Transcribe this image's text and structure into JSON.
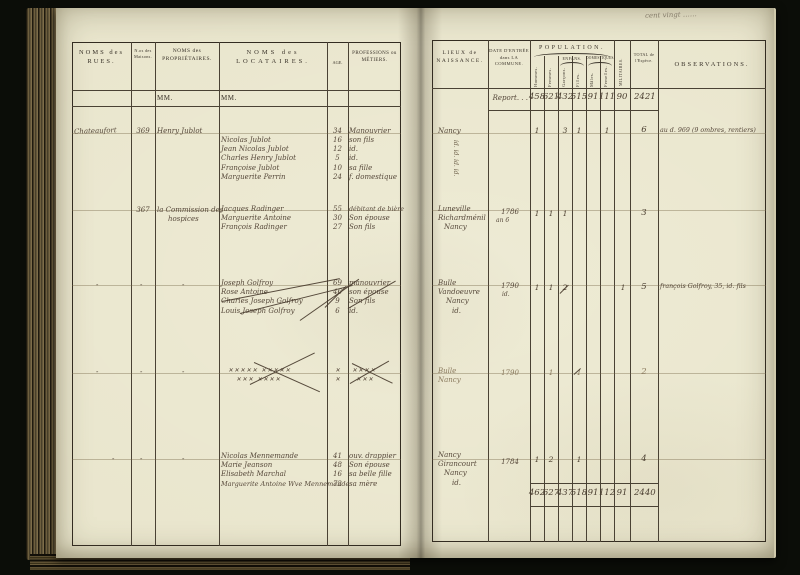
{
  "pencil_note": "cent vingt ……",
  "left": {
    "header": {
      "rues": "NOMS des RUES.",
      "maisons": "N.os des Maisons.",
      "proprietaires": "NOMS des PROPRIÉTAIRES.",
      "locataires": "NOMS des LOCATAIRES.",
      "age": "AGE.",
      "professions": "PROFESSIONS ou MÉTIERS."
    },
    "mm": "MM.",
    "ditto": "-",
    "b1": {
      "rue": "Chateaufort",
      "maison": "369",
      "proprietaire": "Henry Jublot",
      "prop_age": "34",
      "prop_profession": "Manouvrier",
      "loc": [
        {
          "n": "Nicolas Jublot",
          "a": "16",
          "p": "son fils"
        },
        {
          "n": "Jean Nicolas Jublot",
          "a": "12",
          "p": "id."
        },
        {
          "n": "Charles Henry Jublot",
          "a": "5",
          "p": "id."
        },
        {
          "n": "Françoise Jublot",
          "a": "10",
          "p": "sa fille"
        },
        {
          "n": "Marguerite Perrin",
          "a": "24",
          "p": "f. domestique"
        }
      ]
    },
    "b2": {
      "maison": "367",
      "prop1": "la Commission des",
      "prop2": "hospices",
      "loc": [
        {
          "n": "Jacques Radinger",
          "a": "55",
          "p": "débitant de bière"
        },
        {
          "n": "Marguerite Antoine",
          "a": "30",
          "p": "Son épouse"
        },
        {
          "n": "François Radinger",
          "a": "27",
          "p": "Son fils"
        }
      ]
    },
    "b3": {
      "loc": [
        {
          "n": "Joseph Golfroy",
          "a": "69",
          "p": "manouvrier"
        },
        {
          "n": "Rose Antoine",
          "a": "46",
          "p": "son épouse"
        },
        {
          "n": "Charles Joseph Golfroy",
          "a": "9",
          "p": "Son fils"
        },
        {
          "n": "Louis Joseph Golfroy",
          "a": "6",
          "p": "id."
        }
      ]
    },
    "b4": {
      "l1": "✕✕✕✕✕ ✕✕✕✕✕",
      "l2": "✕✕✕ ✕✕✕✕",
      "a1": "✕",
      "a2": "✕",
      "p1": "✕✕✕✕",
      "p2": "✕✕✕"
    },
    "b5": {
      "loc": [
        {
          "n": "Nicolas Mennemande",
          "a": "41",
          "p": "ouv. drappier"
        },
        {
          "n": "Marie Jeanson",
          "a": "48",
          "p": "Son épouse"
        },
        {
          "n": "Elisabeth Marchal",
          "a": "16",
          "p": "sa belle fille"
        },
        {
          "n": "Marguerite Antoine Wve Mennemande",
          "a": "72",
          "p": "sa mère"
        }
      ]
    }
  },
  "right": {
    "header": {
      "lieux": "LIEUX de NAISSANCE.",
      "date": "DATE D'ENTRÉE dans LA COMMUNE.",
      "population": "POPULATION.",
      "hommes": "Hommes.",
      "femmes": "Femmes.",
      "enfans": "ENFANS.",
      "garcons": "Garçons.",
      "filles": "Filles.",
      "domestiques": "DOMESTIQUES.",
      "males": "Mâles.",
      "femelles": "Femelles.",
      "militaires": "MILITAIRES.",
      "total": "TOTAL de l'Espèce.",
      "observations": "OBSERVATIONS."
    },
    "report_label": "Report. . .",
    "report": [
      "458",
      "621",
      "432",
      "515",
      "91",
      "111",
      "90",
      "2421"
    ],
    "b1": {
      "l1": "Nancy",
      "vert": "id. id. id. id.",
      "pop": [
        "1",
        "",
        "3",
        "1",
        "",
        "1",
        ""
      ],
      "total": "6",
      "obs": "au d. 969 (9 ombres, rentiers)"
    },
    "b2": {
      "l1": "Luneville",
      "l2": "Richardménil",
      "l3": "Nancy",
      "d1": "1786",
      "d2": "an 6",
      "pop": [
        "1",
        "1",
        "1",
        "",
        "",
        "",
        ""
      ],
      "total": "3"
    },
    "b3": {
      "l1": "Bulle",
      "l2": "Vandoeuvre",
      "l3": "Nancy",
      "l4": "id.",
      "d1": "1790",
      "d2": "id.",
      "pop": [
        "1",
        "1",
        "2",
        "",
        "",
        "",
        "1"
      ],
      "total": "5",
      "obs": "françois Golfroy, 35, id. fils"
    },
    "b4": {
      "l1": "Bulle",
      "l2": "Nancy",
      "d1": "1790",
      "pop": [
        "",
        "1",
        "",
        "1",
        "",
        "",
        ""
      ],
      "total": "2"
    },
    "b5": {
      "l1": "Nancy",
      "l2": "Girancourt",
      "l3": "Nancy",
      "l4": "id.",
      "d1": "1784",
      "pop": [
        "1",
        "2",
        "",
        "1",
        "",
        "",
        ""
      ],
      "total": "4"
    },
    "totals": [
      "462",
      "627",
      "437",
      "518",
      "91",
      "112",
      "91",
      "2440"
    ]
  }
}
